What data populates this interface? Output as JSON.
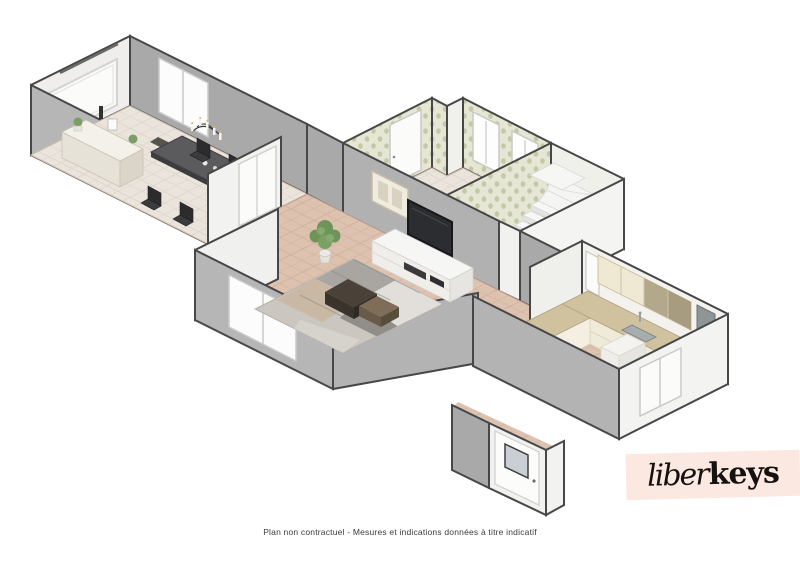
{
  "image": {
    "type": "3d-floor-plan-rendering",
    "style": "isometric-dollhouse-view",
    "background": "#ffffff"
  },
  "footer": {
    "disclaimer": "Plan non contractuel - Mesures et indications données à titre indicatif"
  },
  "brand": {
    "logo_script": "liber",
    "logo_bold": "keys",
    "band_color": "#fbe8e0",
    "text_color": "#15110f"
  },
  "palette": {
    "wall_top": "#474747",
    "wall_exterior_gray": "#b4b4b4",
    "wall_interior_gray": "#a9a9a9",
    "wall_light": "#f3f3f1",
    "floor_terracotta": "#ddc2b0",
    "floor_beige": "#eae4dc",
    "wallpaper": "#e5e6d4",
    "counter_wood": "#d0c19f",
    "cabinet_cream": "#efe9da",
    "stairs_white": "#f6f6f5"
  },
  "rooms": [
    {
      "name": "dining-room",
      "floor": "beige-tile",
      "furniture": [
        "sideboard",
        "wall-mirror",
        "dining-table",
        "dining-chairs",
        "chandelier",
        "doormat"
      ],
      "openings": [
        "window",
        "glazed-double-doors"
      ]
    },
    {
      "name": "living-room",
      "floor": "terracotta-tile",
      "furniture": [
        "tv-stand",
        "tv",
        "area-rug",
        "coffee-tables",
        "potted-plant",
        "wall-art"
      ],
      "openings": [
        "bay-window"
      ]
    },
    {
      "name": "bathroom-laundry",
      "floor": "beige-tile",
      "wall_finish": "patterned-wallpaper",
      "furniture": [
        "washing-machine",
        "wooden-stool"
      ],
      "openings": [
        "door",
        "window",
        "window"
      ]
    },
    {
      "name": "stair-hall",
      "furniture": [
        "winder-staircase"
      ]
    },
    {
      "name": "kitchen",
      "floor": "terracotta-tile",
      "furniture": [
        "l-shaped-counter",
        "sink",
        "cooktop-oven",
        "range-hood",
        "upper-cabinets",
        "tall-cabinet"
      ],
      "openings": [
        "window",
        "window"
      ]
    },
    {
      "name": "entry",
      "openings": [
        "glazed-entry-door"
      ]
    }
  ]
}
